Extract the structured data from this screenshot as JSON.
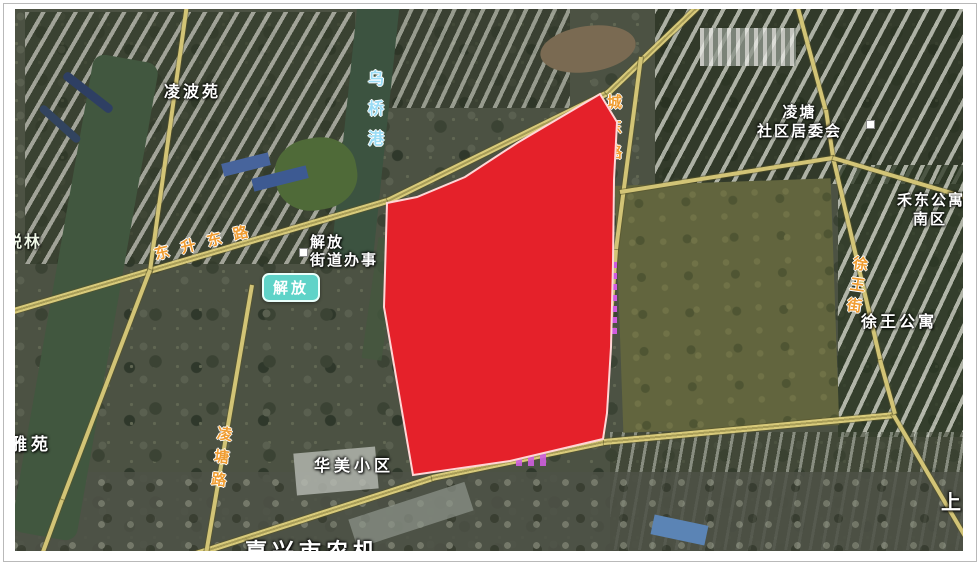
{
  "map": {
    "type": "satellite",
    "labels": {
      "lingboyuan": "凌波苑",
      "wuqiaogang": "乌桥港",
      "dongsheng_donglu": "东升东路",
      "jiefang_office_line1": "解放",
      "jiefang_office_line2": "街道办事",
      "jiefang_badge": "解放",
      "yuelin": "悦林",
      "yayuan": "雅苑",
      "lingtang_lu": "凌塘路",
      "huamei_xiaoqu": "华美小区",
      "jiaxing_nongji": "嘉兴市农机",
      "chengdong_lu": "城东路",
      "lingtang_shequ_line1": "凌塘",
      "lingtang_shequ_line2": "社区居委会",
      "hedong_gongyu_line1": "禾东公寓",
      "hedong_gongyu_line2": "南区",
      "xuwang_jie": "徐王街",
      "xuwang_gongyu": "徐王公寓",
      "shang": "上"
    },
    "overlay": {
      "shape": "polygon",
      "fill": "#e5212a",
      "stroke": "#ffd6d6",
      "stroke_width": 2,
      "points": "600,94 517,143 465,177 417,197 387,203 384,307 413,475 510,461 603,439 607,413 611,347 613,263 614,180 617,122"
    },
    "colors": {
      "road": "#d2c476",
      "road_label": "#f09d32",
      "water_label": "#9adcf5",
      "poi_label": "#ffffff",
      "badge_background": "#5fd3c8",
      "highlight_fill": "#e5212a"
    }
  }
}
